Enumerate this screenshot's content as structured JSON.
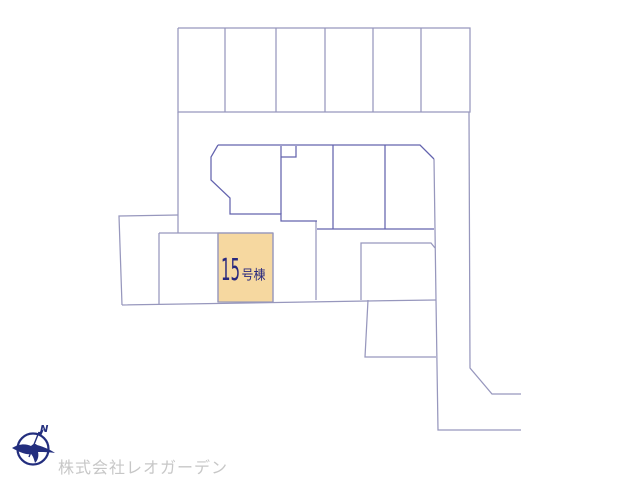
{
  "map": {
    "colors": {
      "line": "#9797bd",
      "line_dark": "#6363ae",
      "highlight_fill": "#F6D8A0",
      "highlight_stroke": "#9b9bb8",
      "label": "#28287E"
    },
    "highlight": {
      "polygon": "218,233 273,233 273,302 218,302",
      "label_main": "15",
      "label_suffix": "号棟"
    },
    "segments": [
      {
        "cls": "g",
        "pts": "178,28 470,28 470,112 178,112 178,28"
      },
      {
        "cls": "g",
        "pts": "225,28 225,112"
      },
      {
        "cls": "g",
        "pts": "276,28 276,112"
      },
      {
        "cls": "g",
        "pts": "325,28 325,112"
      },
      {
        "cls": "g",
        "pts": "373,28 373,112"
      },
      {
        "cls": "g",
        "pts": "421,28 421,112"
      },
      {
        "cls": "g",
        "pts": "469,112 470,368 492,394 521,394"
      },
      {
        "cls": "g",
        "pts": "178,112 178,233"
      },
      {
        "cls": "g",
        "pts": "178,215 119,216 122,305"
      },
      {
        "cls": "g",
        "pts": "122,305 367,301 436,300"
      },
      {
        "cls": "g",
        "pts": "159,233 273,233"
      },
      {
        "cls": "g",
        "pts": "159,233 159,304"
      },
      {
        "cls": "g",
        "pts": "218,233 218,302"
      },
      {
        "cls": "g",
        "pts": "273,233 273,302"
      },
      {
        "cls": "g",
        "pts": "434,159 436,300 438,430 521,430"
      },
      {
        "cls": "g",
        "pts": "361,300 361,243 431,243 435,248"
      },
      {
        "cls": "g",
        "pts": "368,300 365,357 436,357"
      },
      {
        "cls": "g",
        "pts": "316,221 316,300"
      },
      {
        "cls": "d",
        "pts": "218,145 420,145 434,159"
      },
      {
        "cls": "d",
        "pts": "218,145 211,157 211,180 230,198 230,214 281,214 281,221 317,221"
      },
      {
        "cls": "d",
        "pts": "281,146 281,214"
      },
      {
        "cls": "d",
        "pts": "296,146 296,157 281,157"
      },
      {
        "cls": "d",
        "pts": "333,145 333,229"
      },
      {
        "cls": "d",
        "pts": "385,145 385,229"
      },
      {
        "cls": "d",
        "pts": "317,229 434,229"
      }
    ]
  },
  "footer": {
    "company": "株式会社レオガーデン",
    "company_color": "#c7c7c7",
    "logo_color": "#232e7e",
    "compass_north": "N"
  }
}
